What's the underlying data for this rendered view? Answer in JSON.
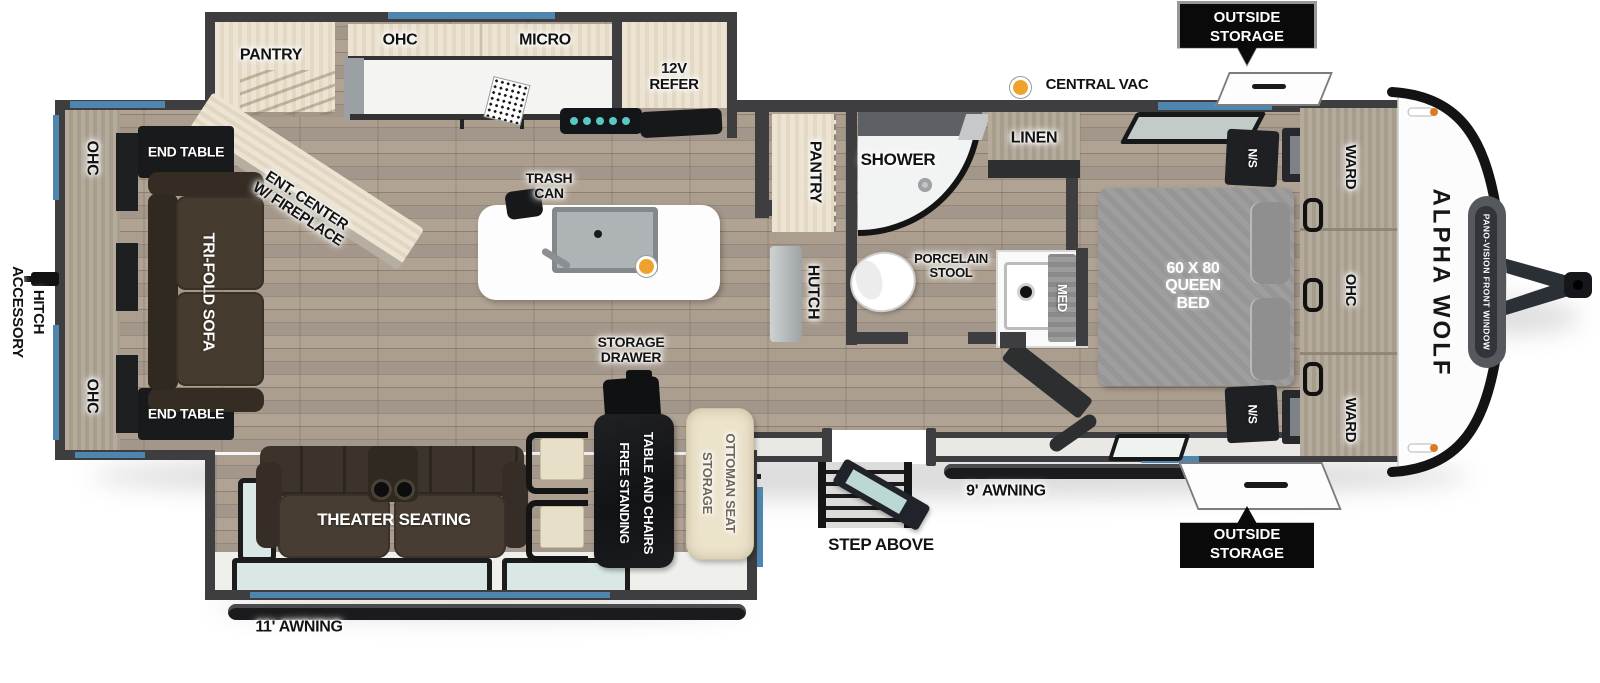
{
  "title": "Alpha Wolf travel trailer floor plan",
  "colors": {
    "accent_window_blue": "#4f86b0",
    "wall_dark": "#3e3d3f",
    "floor_wood": "#a3968a",
    "cabinet_cream": "#ebe2cf",
    "cabinet_gray_wood": "#aea595",
    "sofa_brown": "#42382c",
    "bed_gray": "#9c9c9c",
    "badge_black": "#0a0a0a",
    "marker_orange": "#eda32b"
  },
  "exterior": {
    "brand": "ALPHA WOLF",
    "front_window": "PANO-VISION FRONT WINDOW",
    "central_vac": "CENTRAL VAC",
    "step_above": "STEP ABOVE",
    "awning_door_side": "9' AWNING",
    "awning_camp_side": "11' AWNING",
    "accessory_hitch": [
      "ACCESSORY",
      "HITCH"
    ],
    "outside_storage_front": [
      "OUTSIDE",
      "STORAGE"
    ],
    "outside_storage_rear": [
      "OUTSIDE",
      "STORAGE"
    ]
  },
  "living_room": {
    "ohc_upper": "OHC",
    "ohc_lower": "OHC",
    "end_table_upper": "END TABLE",
    "end_table_lower": "END TABLE",
    "sofa": "TRI-FOLD SOFA",
    "ent_center": [
      "ENT. CENTER",
      "W/ FIREPLACE"
    ],
    "theater_seating": "THEATER SEATING",
    "table": [
      "FREE STANDING",
      "TABLE AND CHAIRS"
    ],
    "ottoman": [
      "STORAGE",
      "OTTOMAN SEAT"
    ],
    "storage_drawer": [
      "STORAGE",
      "DRAWER"
    ]
  },
  "kitchen": {
    "pantry": "PANTRY",
    "ohc": "OHC",
    "micro": "MICRO",
    "refrigerator": [
      "12V",
      "REFER"
    ],
    "trash_can": [
      "TRASH",
      "CAN"
    ]
  },
  "hall": {
    "pantry": "PANTRY",
    "hutch": "HUTCH"
  },
  "bathroom": {
    "shower": "SHOWER",
    "linen": "LINEN",
    "toilet": [
      "PORCELAIN",
      "STOOL"
    ],
    "medicine_cabinet": "MED"
  },
  "bedroom": {
    "bed": [
      "60 X 80",
      "QUEEN",
      "BED"
    ],
    "nightstand_upper": "N/S",
    "nightstand_lower": "N/S",
    "wardrobe_upper": "WARD",
    "ohc": "OHC",
    "wardrobe_lower": "WARD"
  }
}
